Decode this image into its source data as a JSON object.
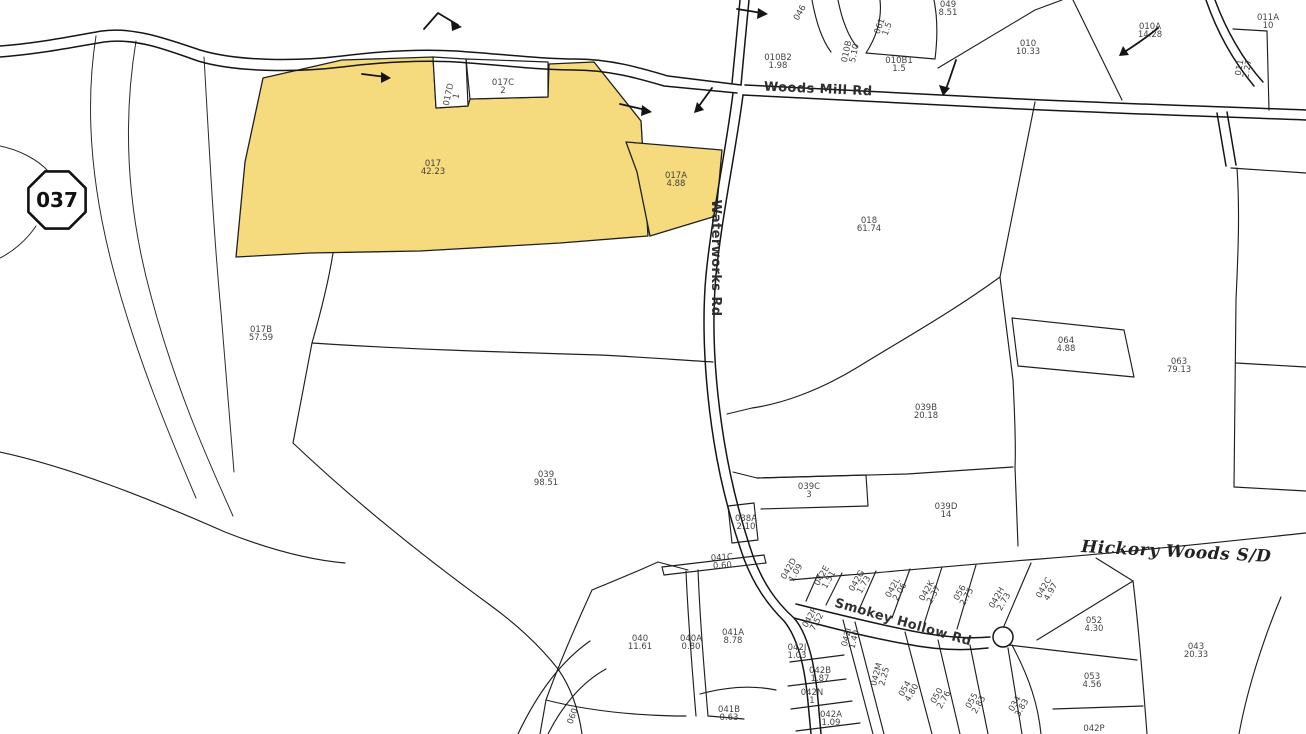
{
  "map": {
    "badge": {
      "label": "037"
    },
    "colors": {
      "highlight": "#F6DB7E",
      "line": "#1f1f1f",
      "background": "#FFFFFF"
    },
    "roads": [
      {
        "name": "Woods Mill Rd",
        "x": 818,
        "y": 93,
        "rot": 2.5,
        "cls": "roadlbl",
        "anchor": "middle"
      },
      {
        "name": "Waterworks Rd",
        "x": 712,
        "y": 258,
        "rot": 90,
        "cls": "roadlbl",
        "anchor": "start"
      },
      {
        "name": "Smokey Hollow Rd",
        "x": 902,
        "y": 626,
        "rot": 16,
        "cls": "roadlbl",
        "anchor": "middle"
      },
      {
        "name": "Hickory Woods S/D",
        "x": 1176,
        "y": 557,
        "rot": 3,
        "cls": "subdivlbl",
        "anchor": "middle"
      }
    ],
    "highlighted_parcels": [
      "017",
      "017A"
    ],
    "parcels": [
      {
        "id": "017",
        "acres": "42.23",
        "x": 433,
        "y": 166,
        "highlighted": true
      },
      {
        "id": "017A",
        "acres": "4.88",
        "x": 676,
        "y": 178,
        "highlighted": true
      },
      {
        "id": "017C",
        "acres": "2",
        "x": 503,
        "y": 85
      },
      {
        "id": "017D",
        "acres": "1",
        "x": 451,
        "y": 95,
        "rot": -78
      },
      {
        "id": "017B",
        "acres": "57.59",
        "x": 261,
        "y": 332
      },
      {
        "id": "039",
        "acres": "98.51",
        "x": 546,
        "y": 477
      },
      {
        "id": "018",
        "acres": "61.74",
        "x": 869,
        "y": 223
      },
      {
        "id": "064",
        "acres": "4.88",
        "x": 1066,
        "y": 343
      },
      {
        "id": "063",
        "acres": "79.13",
        "x": 1179,
        "y": 364
      },
      {
        "id": "039B",
        "acres": "20.18",
        "x": 926,
        "y": 410
      },
      {
        "id": "039C",
        "acres": "3",
        "x": 809,
        "y": 489
      },
      {
        "id": "039D",
        "acres": "14",
        "x": 946,
        "y": 509
      },
      {
        "id": "038A",
        "acres": "2.10",
        "x": 746,
        "y": 521
      },
      {
        "id": "041C",
        "acres": "0.60",
        "x": 722,
        "y": 560,
        "rot": -4
      },
      {
        "id": "010B2",
        "acres": "1.98",
        "x": 778,
        "y": 60
      },
      {
        "id": "010B",
        "acres": "5.10",
        "x": 849,
        "y": 52,
        "rot": -78
      },
      {
        "id": "061",
        "acres": "1.5",
        "x": 882,
        "y": 27,
        "rot": -70
      },
      {
        "id": "010B1",
        "acres": "1.5",
        "x": 899,
        "y": 63
      },
      {
        "id": "049",
        "acres": "8.51",
        "x": 948,
        "y": 7
      },
      {
        "id": "046",
        "acres": "",
        "x": 802,
        "y": 14,
        "rot": -60
      },
      {
        "id": "010",
        "acres": "10.33",
        "x": 1028,
        "y": 46
      },
      {
        "id": "010A",
        "acres": "14.28",
        "x": 1150,
        "y": 29
      },
      {
        "id": "011A",
        "acres": "10",
        "x": 1268,
        "y": 20
      },
      {
        "id": "011",
        "acres": "2.27",
        "x": 1242,
        "y": 68,
        "rot": -80
      },
      {
        "id": "040",
        "acres": "11.61",
        "x": 640,
        "y": 641
      },
      {
        "id": "040A",
        "acres": "0.80",
        "x": 691,
        "y": 641
      },
      {
        "id": "041A",
        "acres": "8.78",
        "x": 733,
        "y": 635
      },
      {
        "id": "041B",
        "acres": "0.63",
        "x": 729,
        "y": 712
      },
      {
        "id": "042D",
        "acres": "1.09",
        "x": 791,
        "y": 570,
        "rot": -60
      },
      {
        "id": "042E",
        "acres": "1.51",
        "x": 824,
        "y": 577,
        "rot": -60
      },
      {
        "id": "042G",
        "acres": "1.73",
        "x": 859,
        "y": 582,
        "rot": -60
      },
      {
        "id": "042L",
        "acres": "2.06",
        "x": 895,
        "y": 589,
        "rot": -60
      },
      {
        "id": "042K",
        "acres": "2.37",
        "x": 929,
        "y": 592,
        "rot": -60
      },
      {
        "id": "056",
        "acres": "2.75",
        "x": 962,
        "y": 594,
        "rot": -60
      },
      {
        "id": "042H",
        "acres": "2.73",
        "x": 999,
        "y": 599,
        "rot": -60
      },
      {
        "id": "042C",
        "acres": "4.97",
        "x": 1046,
        "y": 589,
        "rot": -60
      },
      {
        "id": "042F",
        "acres": "7.52",
        "x": 812,
        "y": 619,
        "rot": -60
      },
      {
        "id": "042J",
        "acres": "1.03",
        "x": 797,
        "y": 650
      },
      {
        "id": "042B",
        "acres": "1.87",
        "x": 820,
        "y": 673
      },
      {
        "id": "042N",
        "acres": "1",
        "x": 812,
        "y": 695
      },
      {
        "id": "042A",
        "acres": "1.09",
        "x": 831,
        "y": 717
      },
      {
        "id": "042M",
        "acres": "2.25",
        "x": 879,
        "y": 675,
        "rot": -75
      },
      {
        "id": "042I",
        "acres": "1.40",
        "x": 849,
        "y": 638,
        "rot": -75
      },
      {
        "id": "054",
        "acres": "4.80",
        "x": 907,
        "y": 690,
        "rot": -60
      },
      {
        "id": "050",
        "acres": "2.76",
        "x": 939,
        "y": 697,
        "rot": -60
      },
      {
        "id": "055",
        "acres": "2.83",
        "x": 974,
        "y": 702,
        "rot": -60
      },
      {
        "id": "034",
        "acres": "3.83",
        "x": 1017,
        "y": 705,
        "rot": -60
      },
      {
        "id": "052",
        "acres": "4.30",
        "x": 1094,
        "y": 623
      },
      {
        "id": "053",
        "acres": "4.56",
        "x": 1092,
        "y": 679
      },
      {
        "id": "043",
        "acres": "20.33",
        "x": 1196,
        "y": 649
      },
      {
        "id": "042P",
        "acres": "",
        "x": 1094,
        "y": 731
      },
      {
        "id": "060",
        "acres": "",
        "x": 575,
        "y": 717,
        "rot": -70
      }
    ]
  }
}
